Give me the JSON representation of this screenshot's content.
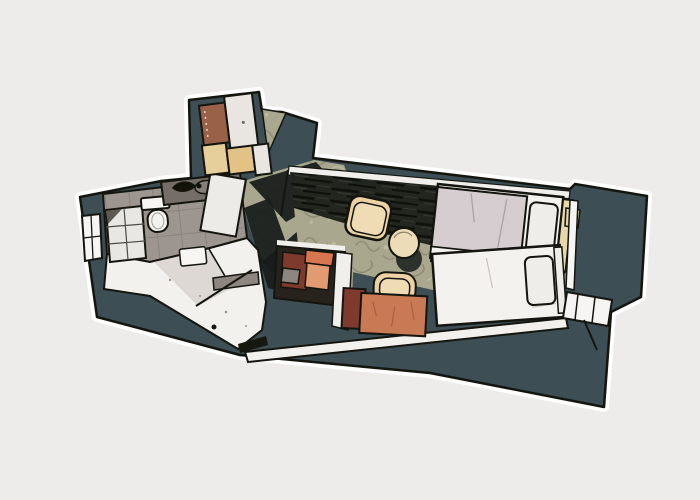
{
  "scene": {
    "type": "illustration",
    "subject": "stylized-floor-plan",
    "description": "Comic-style top-down floor plan illustration of a small apartment / twin hotel room drawn on a tilted dark slab over a light gray background",
    "canvas": {
      "width": 700,
      "height": 500
    }
  },
  "colors": {
    "background": "#edecea",
    "halo": "#ffffff",
    "outline": "#14150f",
    "slab": "#3d4e54",
    "carpet": "#a9a88f",
    "dark_floor": "#23261f",
    "shadow": "#181c1b",
    "tile_gray": "#9d9590",
    "floor_white": "#f3f1ee",
    "wall_white": "#f1efec",
    "wedge_gray": "#d8d4cf",
    "counter_gray": "#756e68",
    "basin_gray": "#857e78",
    "fixture_white": "#f7f6f3",
    "shower_glass": "#e9e7e3",
    "shelf_dark": "#5f5954",
    "door_white": "#edebe8",
    "threshold_black": "#16170f",
    "wardrobe_brown": "#9a6149",
    "wardrobe_cream": "#e7cf9b",
    "wardrobe_tan": "#e3c285",
    "panel_white": "#e9e5e1",
    "duvet_gray": "#d5cdd0",
    "linen_white": "#f4f2ef",
    "pillow_white": "#efede9",
    "headboard_cream": "#e8d7a8",
    "armchair_tan": "#ecd2a4",
    "armchair_inner": "#f0dcb4",
    "table_cream": "#ecdcb8",
    "desk_terracotta": "#c97a55",
    "desk_maroon": "#7e3a2c",
    "box_orange": "#d8764f",
    "box_orange_light": "#e29a71",
    "box_gray": "#8d8580",
    "niche_dark": "#27221c",
    "window_white": "#f6f5f3"
  },
  "rooms": [
    {
      "id": "bathroom",
      "label": "bathroom",
      "features": [
        "shower",
        "toilet",
        "sink-counter",
        "bath-door",
        "left-window"
      ]
    },
    {
      "id": "entry-hall",
      "label": "entry hall",
      "features": [
        "entry-door-swing",
        "threshold",
        "wardrobe"
      ]
    },
    {
      "id": "corridor",
      "label": "corridor",
      "features": [
        "patterned-carpet",
        "cast-shadows",
        "minibar-niche"
      ]
    },
    {
      "id": "bedroom",
      "label": "bedroom",
      "features": [
        "bed-1",
        "bed-2",
        "armchair",
        "side-table",
        "desk",
        "desk-chair",
        "right-windows"
      ]
    }
  ]
}
